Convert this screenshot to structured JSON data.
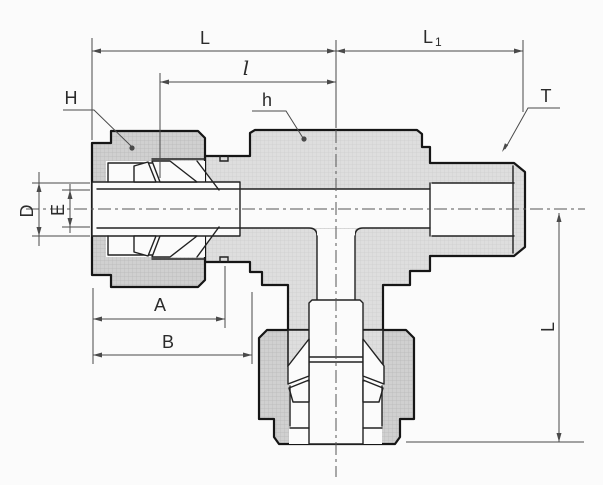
{
  "drawing": {
    "kind": "technical-dimension-drawing",
    "dimension_labels": {
      "L_top": "L",
      "L1_main": "L",
      "L1_sub": "1",
      "l_mid": "l",
      "H": "H",
      "h": "h",
      "T": "T",
      "D": "D",
      "E": "E",
      "A": "A",
      "B": "B",
      "L_branch": "L"
    },
    "colors": {
      "background": "#fbfbfb",
      "outline": "#161616",
      "body_fill": "#dedede",
      "nut_fill": "#d0d0d0",
      "dimension_lines": "#4a4a4a",
      "text": "#2b2b2b"
    }
  }
}
